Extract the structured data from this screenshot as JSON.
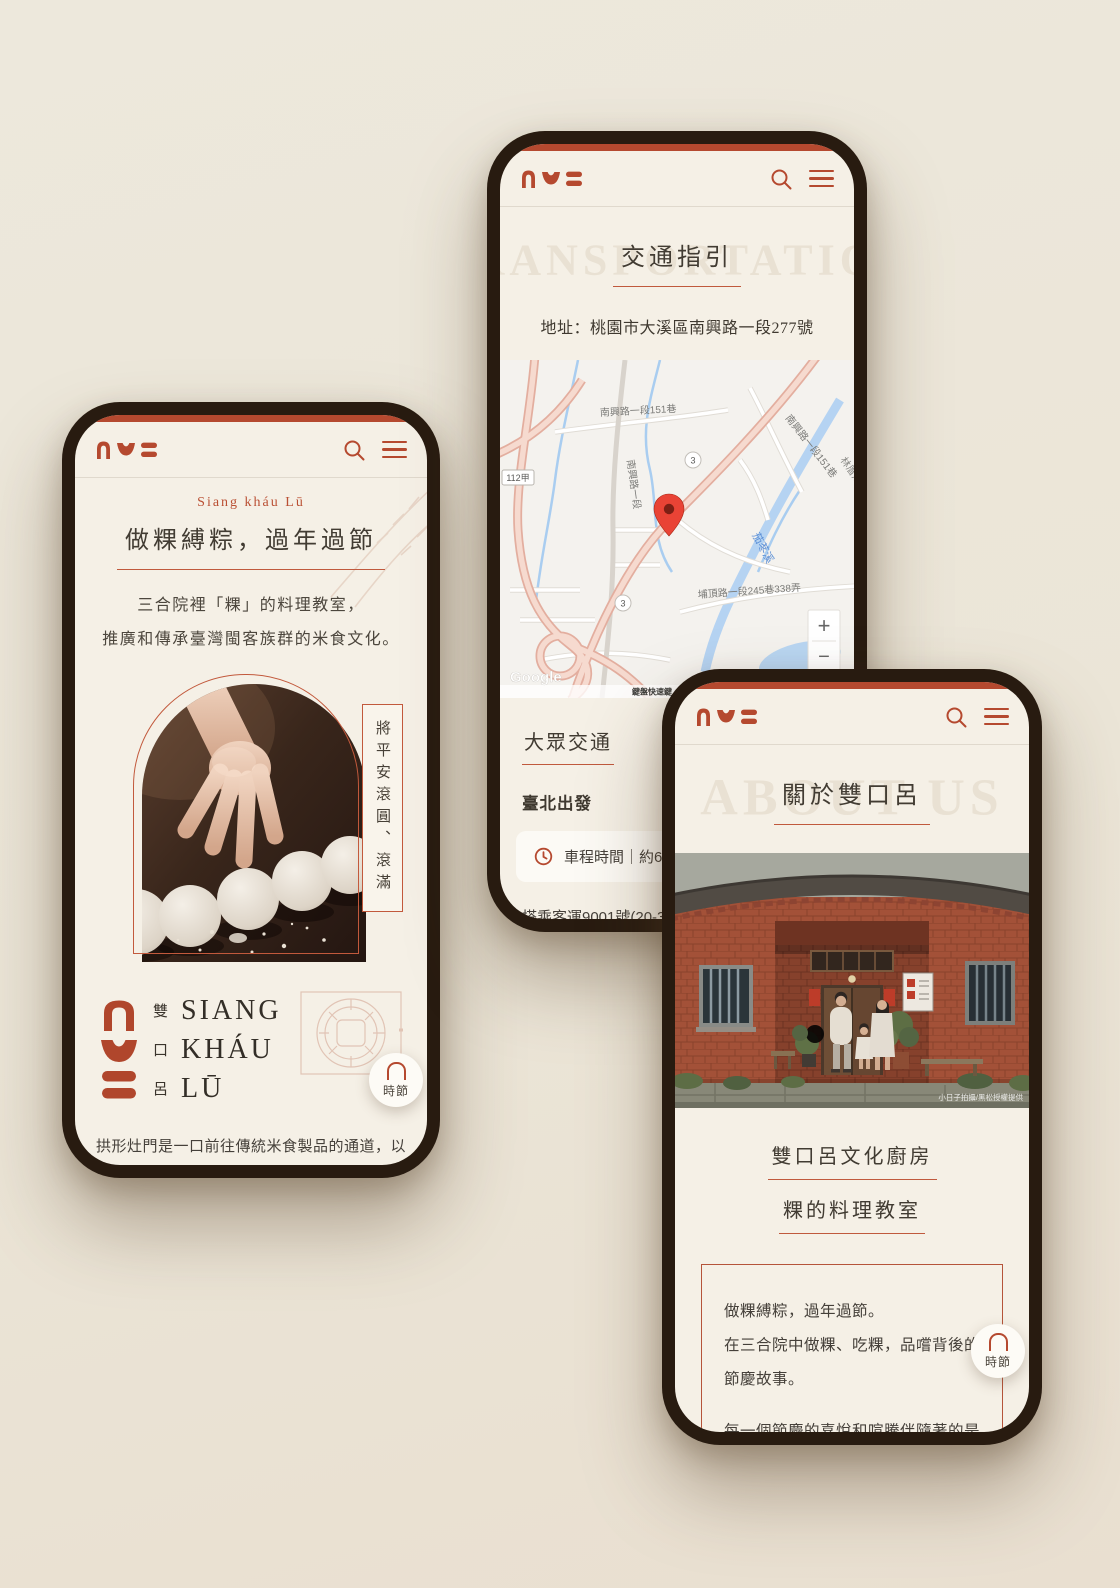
{
  "brand": {
    "accent": "#B5492F",
    "ink": "#45403A",
    "bezel": "#281B10",
    "screen_bg": "#F5F0E6"
  },
  "header": {
    "search_icon": "search",
    "menu_icon": "menu"
  },
  "float_button": {
    "label": "時節",
    "icon": "arch"
  },
  "phone1": {
    "eyebrow": "Siang kháu Lū",
    "title": "做粿縛粽，過年過節",
    "intro_lines": [
      "三合院裡「粿」的料理教室，",
      "推廣和傳承臺灣閩客族群的米食文化。"
    ],
    "photo_tag": "將平安滾圓、滾滿",
    "logo": {
      "zh": [
        "雙",
        "口",
        "呂"
      ],
      "en": [
        "SIANG",
        "KHÁU",
        "LŪ"
      ]
    },
    "footer_lines": [
      "拱形灶門是一口前往傳統米食製品的通道，以碗",
      "就口，品嚐先人的敬穀謝天，走讀節慶的豐饒。"
    ]
  },
  "phone2": {
    "ghost": "TRANSPORTATION",
    "title": "交通指引",
    "address": "地址：桃園市大溪區南興路一段277號",
    "map": {
      "road_151_a": "南興路一段151巷",
      "road_151_b": "南興路一段151巷",
      "road_nanxing": "南興路一段",
      "road_puding": "埔頂路一段245巷338弄",
      "badge_112": "112甲",
      "shield_3": "3",
      "river": "茄苳溪",
      "hamlet": "林厝角",
      "google": "Google",
      "keyboard": "鍵盤快速鍵",
      "attribution": "地圖資料 ©2024 Google",
      "terms": "條款",
      "zoom_in": "+",
      "zoom_out": "−"
    },
    "section_title": "大眾交通",
    "depart": "臺北出發",
    "card_text": "車程時間｜約60-",
    "body_lines": [
      "搭乘客運9001號(20-30",
      "市政府轉運站或其他臺"
    ]
  },
  "phone3": {
    "ghost": "ABOUT US",
    "title": "關於雙口呂",
    "photo_caption": "小日子拍攝/黑松授權提供",
    "heading_1": "雙口呂文化廚房",
    "heading_2": "粿的料理教室",
    "box_p1": [
      "做粿縛粽，過年過節。",
      "在三合院中做粿、吃粿，品嚐背後的",
      "節慶故事。"
    ],
    "box_p2": [
      "每一個節慶的喜悅和喧騰伴隨著的是",
      "每一位辛勤婦女穿梭廳堂和廚房，而",
      "其中每一位阿嬤都是最鮮明的代表。",
      "看著阿嬤做粿的背影長大，從你我"
    ]
  }
}
